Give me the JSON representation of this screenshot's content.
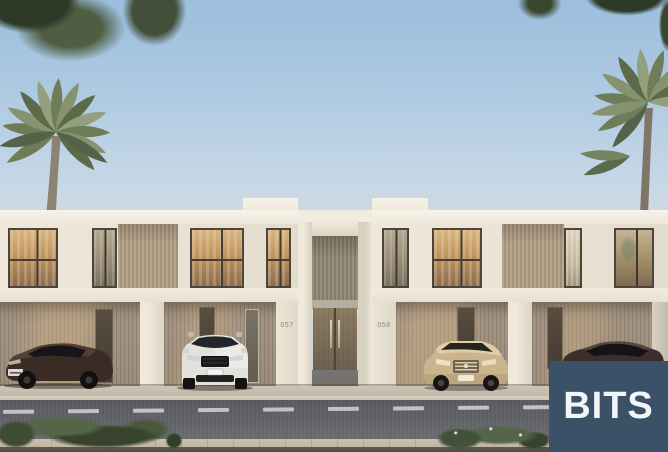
{
  "scene": {
    "alt": "Rendering of two modern white two-storey townhouses with wood-slat carports, four parked cars, palm trees and a street in front",
    "units": {
      "left": "057",
      "right": "058"
    }
  },
  "watermark": {
    "text": "BITS",
    "background": "#3a5168",
    "color": "#f3f6f8"
  },
  "palette": {
    "sky_top": "#9cbedd",
    "sky_horizon": "#e7e3d7",
    "facade": "#ece5d7",
    "facade_shadow": "#d9d1c1",
    "wood_slat": "#b0a089",
    "carport_wall": "#a09079",
    "door_wood": "#7d6c55",
    "window_glow": "#c99c66",
    "road": "#5e5f63",
    "sidewalk": "#c8bfb0",
    "paver": "#c6bcab",
    "foliage_dark": "#33402b",
    "palm_green": "#7a8762"
  }
}
